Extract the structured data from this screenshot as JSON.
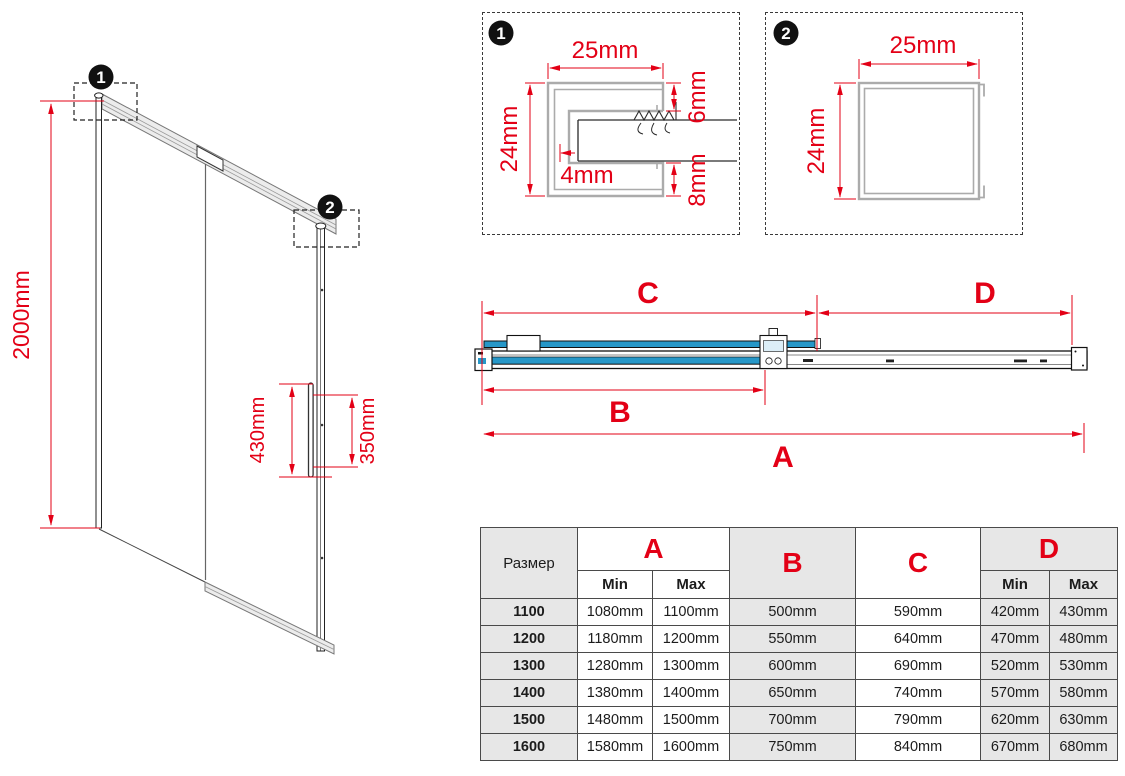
{
  "colors": {
    "dimension_red": "#e30016",
    "glass_blue": "#2697c8",
    "profile_gray": "#ababab",
    "table_gray": "#e7e7e7"
  },
  "isometric": {
    "callout_1": "1",
    "callout_2": "2",
    "height_dim": "2000mm",
    "handle_dim_outer": "430mm",
    "handle_dim_inner": "350mm"
  },
  "detail_1": {
    "label": "1",
    "width_dim": "25mm",
    "height_dim": "24mm",
    "top_gap_dim": "6mm",
    "wall_dim": "4mm",
    "bottom_gap_dim": "8mm"
  },
  "detail_2": {
    "label": "2",
    "width_dim": "25mm",
    "height_dim": "24mm"
  },
  "plan_view": {
    "dim_a": "A",
    "dim_b": "B",
    "dim_c": "C",
    "dim_d": "D"
  },
  "table": {
    "size_header": "Размер",
    "col_a": "A",
    "col_b": "B",
    "col_c": "C",
    "col_d": "D",
    "min_label": "Min",
    "max_label": "Max",
    "rows": [
      {
        "size": "1100",
        "a_min": "1080mm",
        "a_max": "1100mm",
        "b": "500mm",
        "c": "590mm",
        "d_min": "420mm",
        "d_max": "430mm"
      },
      {
        "size": "1200",
        "a_min": "1180mm",
        "a_max": "1200mm",
        "b": "550mm",
        "c": "640mm",
        "d_min": "470mm",
        "d_max": "480mm"
      },
      {
        "size": "1300",
        "a_min": "1280mm",
        "a_max": "1300mm",
        "b": "600mm",
        "c": "690mm",
        "d_min": "520mm",
        "d_max": "530mm"
      },
      {
        "size": "1400",
        "a_min": "1380mm",
        "a_max": "1400mm",
        "b": "650mm",
        "c": "740mm",
        "d_min": "570mm",
        "d_max": "580mm"
      },
      {
        "size": "1500",
        "a_min": "1480mm",
        "a_max": "1500mm",
        "b": "700mm",
        "c": "790mm",
        "d_min": "620mm",
        "d_max": "630mm"
      },
      {
        "size": "1600",
        "a_min": "1580mm",
        "a_max": "1600mm",
        "b": "750mm",
        "c": "840mm",
        "d_min": "670mm",
        "d_max": "680mm"
      }
    ]
  }
}
